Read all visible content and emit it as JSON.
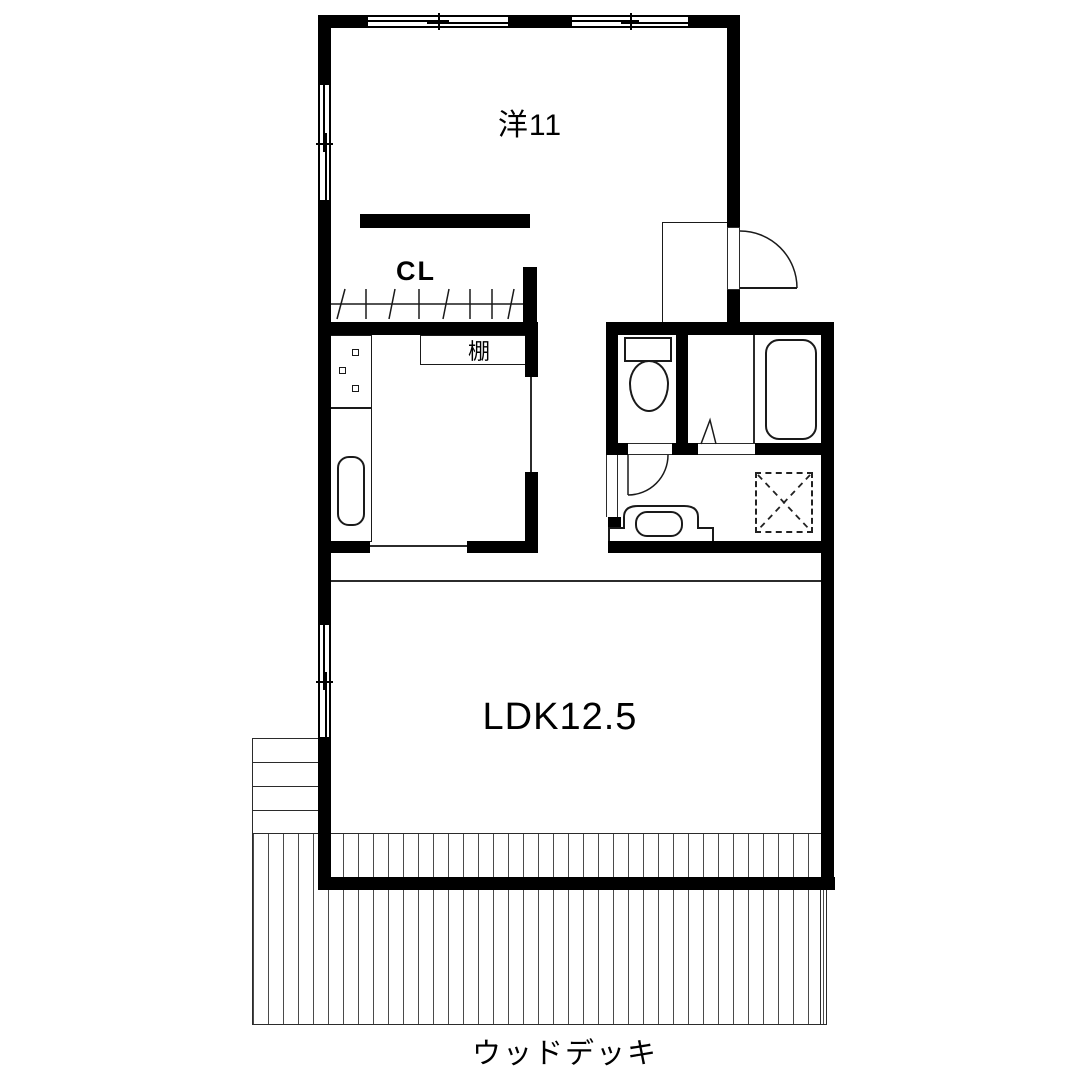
{
  "labels": {
    "western_room": "洋11",
    "closet": "CL",
    "shelf": "棚",
    "ldk": "LDK12.5",
    "wood_deck": "ウッドデッキ"
  },
  "colors": {
    "wall": "#000000",
    "line": "#2b2b2b",
    "hatch": "#4a4a4a",
    "background": "#ffffff",
    "text": "#000000"
  }
}
